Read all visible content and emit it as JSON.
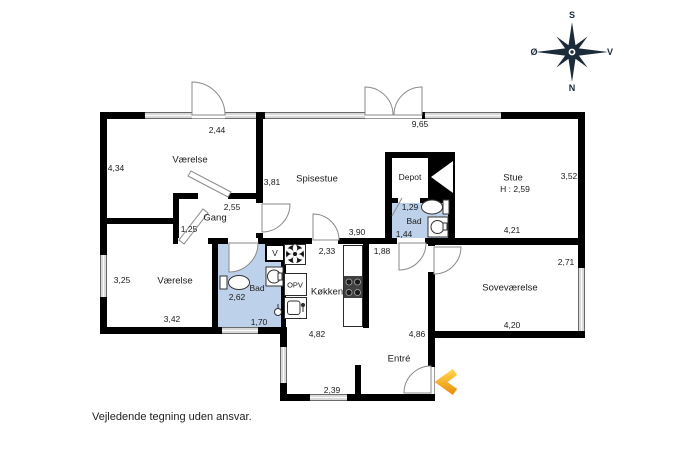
{
  "disclaimer": "Vejledende tegning uden ansvar.",
  "compass": {
    "top": "S",
    "right": "V",
    "bottom": "N",
    "left": "Ø"
  },
  "colors": {
    "wall": "#000000",
    "bath_fill": "#bed1ea",
    "window_fill": "#d9d9d9",
    "accent_orange": "#f2a32d",
    "compass_navy": "#1c2b3a"
  },
  "rooms": {
    "vaerelse_nw": {
      "label": "Værelse",
      "dim_top": "2,44",
      "dim_left": "4,34"
    },
    "gang": {
      "label": "Gang",
      "dim_top": "2,55",
      "dim_left": "1,25"
    },
    "spisestue": {
      "label": "Spisestue",
      "dim_top": "9,65",
      "dim_left": "3,81",
      "dim_bottom": "3,90"
    },
    "stue": {
      "label": "Stue",
      "ceiling_height": "H : 2,59",
      "dim_right": "3,52",
      "dim_bottom": "4,21"
    },
    "depot": {
      "label": "Depot"
    },
    "bad_middle": {
      "label": "Bad",
      "dim_top": "1,29",
      "dim_left": "1,44"
    },
    "vaerelse_sw": {
      "label": "Værelse",
      "dim_left": "3,25",
      "dim_bottom": "3,42"
    },
    "bad_sw": {
      "label": "Bad",
      "dim_width": "2,62",
      "dim_bottom": "1,70",
      "closet": "V"
    },
    "koekken": {
      "label": "Køkken",
      "dim_top": "2,33",
      "dishwasher": "OPV"
    },
    "sovevaerelse": {
      "label": "Soveværelse",
      "dim_right": "2,71",
      "dim_bottom": "4,20"
    },
    "entre": {
      "label": "Entré",
      "dim_hall": "1,88",
      "dim_left": "4,82",
      "dim_right": "4,86",
      "dim_bottom": "2,39"
    }
  }
}
